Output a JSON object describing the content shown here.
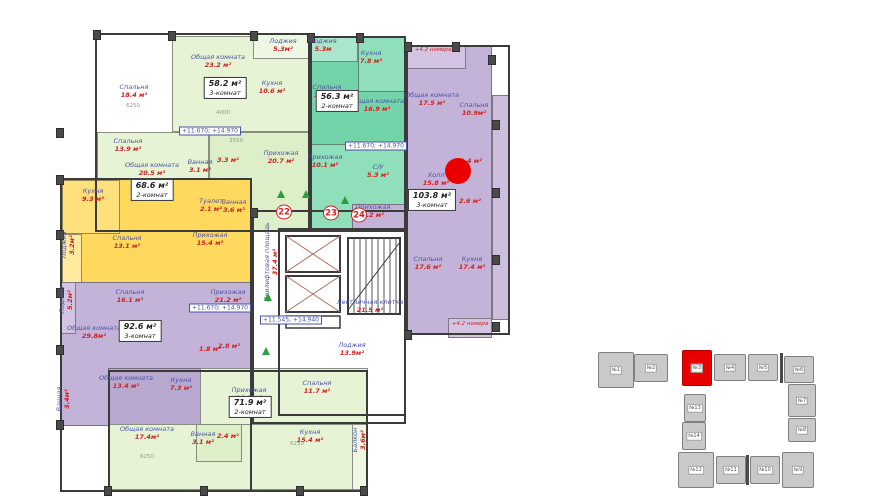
{
  "floorplan": {
    "zones": [
      {
        "name": "apt-58-top-strip",
        "x": 172,
        "y": 36,
        "w": 138,
        "h": 96,
        "color": "#e6f4d5"
      },
      {
        "name": "apt-58-loggia",
        "x": 253,
        "y": 33,
        "w": 62,
        "h": 26,
        "color": "#eef7e2"
      },
      {
        "name": "apt-58-bedrooms",
        "x": 97,
        "y": 132,
        "w": 112,
        "h": 100,
        "color": "#e6f4d5"
      },
      {
        "name": "apt-58-hall",
        "x": 209,
        "y": 132,
        "w": 101,
        "h": 100,
        "color": "#ddefc8"
      },
      {
        "name": "apt-56-base",
        "x": 310,
        "y": 36,
        "w": 96,
        "h": 196,
        "color": "#74d4a9"
      },
      {
        "name": "apt-56-loggia",
        "x": 310,
        "y": 36,
        "w": 48,
        "h": 26,
        "color": "#a9e6cb"
      },
      {
        "name": "apt-56-kitchen",
        "x": 358,
        "y": 36,
        "w": 48,
        "h": 56,
        "color": "#8fdfba"
      },
      {
        "name": "apt-56-hall",
        "x": 310,
        "y": 144,
        "w": 96,
        "h": 88,
        "color": "#8fdfba"
      },
      {
        "name": "apt-103-main",
        "x": 406,
        "y": 45,
        "w": 86,
        "h": 290,
        "color": "#c4b3d8"
      },
      {
        "name": "apt-103-top-room",
        "x": 406,
        "y": 45,
        "w": 60,
        "h": 24,
        "color": "#d2c4e2"
      },
      {
        "name": "apt-103-right-strip",
        "x": 492,
        "y": 95,
        "w": 18,
        "h": 225,
        "color": "#cdbede"
      },
      {
        "name": "apt-103-balcony",
        "x": 448,
        "y": 318,
        "w": 44,
        "h": 20,
        "color": "#d2c4e2"
      },
      {
        "name": "apt-103-entry",
        "x": 352,
        "y": 204,
        "w": 54,
        "h": 28,
        "color": "#c4b3d8"
      },
      {
        "name": "apt-68-base",
        "x": 62,
        "y": 178,
        "w": 190,
        "h": 114,
        "color": "#ffd95e"
      },
      {
        "name": "apt-68-kitchen",
        "x": 62,
        "y": 180,
        "w": 58,
        "h": 54,
        "color": "#ffe07a"
      },
      {
        "name": "apt-68-loggia",
        "x": 62,
        "y": 234,
        "w": 20,
        "h": 58,
        "color": "#ffeaa0"
      },
      {
        "name": "apt-92-base",
        "x": 60,
        "y": 282,
        "w": 192,
        "h": 144,
        "color": "#c4b3d8"
      },
      {
        "name": "apt-92-loggia",
        "x": 60,
        "y": 282,
        "w": 16,
        "h": 52,
        "color": "#d2c4e2"
      },
      {
        "name": "apt-92-bottom",
        "x": 108,
        "y": 368,
        "w": 148,
        "h": 58,
        "color": "#b8a7cf"
      },
      {
        "name": "apt-71-upper",
        "x": 200,
        "y": 368,
        "w": 168,
        "h": 58,
        "color": "#e6f4d5"
      },
      {
        "name": "apt-71-lower",
        "x": 108,
        "y": 424,
        "w": 260,
        "h": 66,
        "color": "#e6f4d5"
      },
      {
        "name": "apt-71-balcony",
        "x": 352,
        "y": 424,
        "w": 16,
        "h": 66,
        "color": "#eef7e2"
      },
      {
        "name": "apt-71-baths",
        "x": 196,
        "y": 424,
        "w": 46,
        "h": 38,
        "color": "#ddefc8"
      }
    ],
    "outlines": [
      {
        "x": 95,
        "y": 33,
        "w": 215,
        "h": 199
      },
      {
        "x": 310,
        "y": 36,
        "w": 96,
        "h": 196
      },
      {
        "x": 406,
        "y": 45,
        "w": 104,
        "h": 290
      },
      {
        "x": 60,
        "y": 178,
        "w": 192,
        "h": 314
      },
      {
        "x": 108,
        "y": 370,
        "w": 260,
        "h": 122
      },
      {
        "x": 252,
        "y": 210,
        "w": 154,
        "h": 214
      },
      {
        "x": 278,
        "y": 228,
        "w": 128,
        "h": 188
      }
    ],
    "columns": [
      [
        93,
        30
      ],
      [
        168,
        31
      ],
      [
        250,
        31
      ],
      [
        307,
        33
      ],
      [
        356,
        33
      ],
      [
        404,
        42
      ],
      [
        452,
        42
      ],
      [
        488,
        55
      ],
      [
        492,
        120
      ],
      [
        492,
        188
      ],
      [
        492,
        255
      ],
      [
        492,
        322
      ],
      [
        56,
        128
      ],
      [
        56,
        175
      ],
      [
        56,
        230
      ],
      [
        56,
        288
      ],
      [
        56,
        345
      ],
      [
        56,
        420
      ],
      [
        104,
        486
      ],
      [
        200,
        486
      ],
      [
        296,
        486
      ],
      [
        360,
        486
      ],
      [
        404,
        330
      ],
      [
        250,
        208
      ]
    ],
    "rooms": [
      {
        "name": "Спальня",
        "area": "18.4 м²",
        "x": 134,
        "y": 92
      },
      {
        "name": "Общая комната",
        "area": "23.2 м²",
        "x": 218,
        "y": 62
      },
      {
        "name": "Спальня",
        "area": "13.9 м²",
        "x": 128,
        "y": 146
      },
      {
        "name": "Лоджия",
        "area": "5.3м²",
        "x": 283,
        "y": 46
      },
      {
        "name": "Кухня",
        "area": "10.6 м²",
        "x": 272,
        "y": 88
      },
      {
        "name": "Прихожая",
        "area": "20.7 м²",
        "x": 281,
        "y": 158
      },
      {
        "name": "Ванная",
        "area": "3.1 м²",
        "x": 200,
        "y": 167
      },
      {
        "name": "",
        "area": "3.3 м²",
        "x": 228,
        "y": 161
      },
      {
        "name": "Лоджия",
        "area": "5.3м",
        "x": 323,
        "y": 46
      },
      {
        "name": "Кухня",
        "area": "7.8 м²",
        "x": 371,
        "y": 58
      },
      {
        "name": "Спальня",
        "area": "13.1 м²",
        "x": 327,
        "y": 92
      },
      {
        "name": "Общая комната",
        "area": "16.9 м²",
        "x": 377,
        "y": 106
      },
      {
        "name": "Прихожая",
        "area": "10.1 м²",
        "x": 325,
        "y": 162
      },
      {
        "name": "С/У",
        "area": "5.3 м²",
        "x": 378,
        "y": 172
      },
      {
        "name": "Общая комната",
        "area": "17.5 м²",
        "x": 432,
        "y": 100
      },
      {
        "name": "Спальня",
        "area": "10.9м²",
        "x": 474,
        "y": 110
      },
      {
        "name": "Холл",
        "area": "15.8 м²",
        "x": 436,
        "y": 180
      },
      {
        "name": "",
        "area": "1.4 м²",
        "x": 471,
        "y": 162
      },
      {
        "name": "",
        "area": "2.6 м²",
        "x": 470,
        "y": 202
      },
      {
        "name": "Прихожая",
        "area": "5.2 м²",
        "x": 373,
        "y": 212
      },
      {
        "name": "Спальня",
        "area": "17.6 м²",
        "x": 428,
        "y": 264
      },
      {
        "name": "Кухня",
        "area": "17.4 м²",
        "x": 472,
        "y": 264
      },
      {
        "name": "Общая комната",
        "area": "20.5 м²",
        "x": 152,
        "y": 170
      },
      {
        "name": "Кухня",
        "area": "9.3 м²",
        "x": 93,
        "y": 196
      },
      {
        "name": "Лоджия",
        "area": "3.2м²",
        "x": 69,
        "y": 245,
        "vert": true
      },
      {
        "name": "Спальня",
        "area": "13.1 м²",
        "x": 127,
        "y": 243
      },
      {
        "name": "Прихожая",
        "area": "15.4 м²",
        "x": 210,
        "y": 240
      },
      {
        "name": "Туалет",
        "area": "2.1 м²",
        "x": 211,
        "y": 206
      },
      {
        "name": "Ванная",
        "area": "3.6 м²",
        "x": 234,
        "y": 207
      },
      {
        "name": "Лоджия",
        "area": "5.2м²",
        "x": 67,
        "y": 300,
        "vert": true
      },
      {
        "name": "Спальня",
        "area": "16.1 м²",
        "x": 130,
        "y": 297
      },
      {
        "name": "Прихожая",
        "area": "21.2 м²",
        "x": 228,
        "y": 297
      },
      {
        "name": "Общая комната",
        "area": "29.8м²",
        "x": 94,
        "y": 333
      },
      {
        "name": "Общая комната",
        "area": "13.4 м²",
        "x": 126,
        "y": 383
      },
      {
        "name": "Кухня",
        "area": "7.3 м²",
        "x": 181,
        "y": 385
      },
      {
        "name": "Ванная",
        "area": "3.4м²",
        "x": 64,
        "y": 399,
        "vert": true
      },
      {
        "name": "",
        "area": "1.8 м²",
        "x": 210,
        "y": 350
      },
      {
        "name": "",
        "area": "2.8 м²",
        "x": 229,
        "y": 347
      },
      {
        "name": "Общая комната",
        "area": "17.4м²",
        "x": 147,
        "y": 434
      },
      {
        "name": "Прихожая",
        "area": "18.5 м²",
        "x": 249,
        "y": 395
      },
      {
        "name": "Спальня",
        "area": "11.7 м²",
        "x": 317,
        "y": 388
      },
      {
        "name": "Кухня",
        "area": "15.4 м²",
        "x": 310,
        "y": 437
      },
      {
        "name": "Ванная",
        "area": "3.1 м²",
        "x": 203,
        "y": 439
      },
      {
        "name": "",
        "area": "2.4 м²",
        "x": 228,
        "y": 437
      },
      {
        "name": "Балкон",
        "area": "3.6м²",
        "x": 360,
        "y": 440,
        "vert": true
      },
      {
        "name": "Лестничная клетка",
        "area": "21.5 м²",
        "x": 370,
        "y": 307
      },
      {
        "name": "Прилифтовая площадь",
        "area": "37.4 м²",
        "x": 272,
        "y": 262,
        "vert": true
      },
      {
        "name": "Лоджия",
        "area": "13.9м²",
        "x": 352,
        "y": 350
      }
    ],
    "badges": [
      {
        "area": "58.2 м²",
        "rooms": "3-комнат",
        "x": 225,
        "y": 88
      },
      {
        "area": "56.3 м²",
        "rooms": "2-комнат",
        "x": 337,
        "y": 101
      },
      {
        "area": "103.8 м²",
        "rooms": "3-комнат",
        "x": 432,
        "y": 200
      },
      {
        "area": "68.6 м²",
        "rooms": "2-комнат",
        "x": 152,
        "y": 190
      },
      {
        "area": "92.6 м²",
        "rooms": "3-комнат",
        "x": 140,
        "y": 331
      },
      {
        "area": "71.9 м²",
        "rooms": "2-комнат",
        "x": 250,
        "y": 407
      }
    ],
    "elevations": [
      {
        "text": "+11.670; +14.970",
        "x": 210,
        "y": 131
      },
      {
        "text": "+11.670; +14.970",
        "x": 376,
        "y": 146
      },
      {
        "text": "+11.670; +14.970",
        "x": 220,
        "y": 308
      },
      {
        "text": "+11.545; +14.940",
        "x": 291,
        "y": 320
      }
    ],
    "annotations": [
      {
        "text": "+4.2 номера",
        "x": 433,
        "y": 50
      },
      {
        "text": "+4.2 номера",
        "x": 470,
        "y": 324
      }
    ],
    "unit_markers": [
      {
        "num": "22",
        "x": 284,
        "y": 212
      },
      {
        "num": "23",
        "x": 331,
        "y": 213
      },
      {
        "num": "24",
        "x": 359,
        "y": 215
      }
    ],
    "triangles": [
      [
        281,
        194
      ],
      [
        306,
        194
      ],
      [
        345,
        200
      ],
      [
        268,
        297
      ],
      [
        266,
        351
      ]
    ],
    "dims": [
      {
        "text": "6250",
        "x": 133,
        "y": 106
      },
      {
        "text": "4000",
        "x": 223,
        "y": 113
      },
      {
        "text": "3550",
        "x": 236,
        "y": 141
      },
      {
        "text": "6250",
        "x": 147,
        "y": 457
      },
      {
        "text": "6250",
        "x": 297,
        "y": 444
      }
    ],
    "selection_dot": {
      "x": 458,
      "y": 171,
      "r": 13,
      "color": "#ea0000"
    }
  },
  "sitemap": {
    "block_color": "#c9c9c9",
    "selected_color": "#e80000",
    "blocks": [
      {
        "label": "№1",
        "x": 598,
        "y": 352,
        "w": 36,
        "h": 36,
        "selected": false
      },
      {
        "label": "№2",
        "x": 634,
        "y": 354,
        "w": 34,
        "h": 28,
        "selected": false
      },
      {
        "label": "№3",
        "x": 682,
        "y": 350,
        "w": 30,
        "h": 36,
        "selected": true
      },
      {
        "label": "№4",
        "x": 714,
        "y": 354,
        "w": 32,
        "h": 27,
        "selected": false
      },
      {
        "label": "№5",
        "x": 748,
        "y": 354,
        "w": 30,
        "h": 27,
        "selected": false
      },
      {
        "label": "№6",
        "x": 784,
        "y": 356,
        "w": 30,
        "h": 27,
        "selected": false
      },
      {
        "label": "№7",
        "x": 788,
        "y": 384,
        "w": 28,
        "h": 33,
        "selected": false
      },
      {
        "label": "№8",
        "x": 788,
        "y": 418,
        "w": 28,
        "h": 24,
        "selected": false
      },
      {
        "label": "№9",
        "x": 782,
        "y": 452,
        "w": 32,
        "h": 36,
        "selected": false
      },
      {
        "label": "№10",
        "x": 750,
        "y": 456,
        "w": 30,
        "h": 28,
        "selected": false
      },
      {
        "label": "№11",
        "x": 716,
        "y": 456,
        "w": 30,
        "h": 28,
        "selected": false
      },
      {
        "label": "№12",
        "x": 678,
        "y": 452,
        "w": 36,
        "h": 36,
        "selected": false
      },
      {
        "label": "№13",
        "x": 684,
        "y": 394,
        "w": 22,
        "h": 28,
        "selected": false
      },
      {
        "label": "№14",
        "x": 682,
        "y": 422,
        "w": 24,
        "h": 28,
        "selected": false
      }
    ],
    "dividers": [
      {
        "x": 780,
        "y": 353,
        "w": 3,
        "h": 30
      },
      {
        "x": 746,
        "y": 455,
        "w": 3,
        "h": 30
      }
    ]
  }
}
